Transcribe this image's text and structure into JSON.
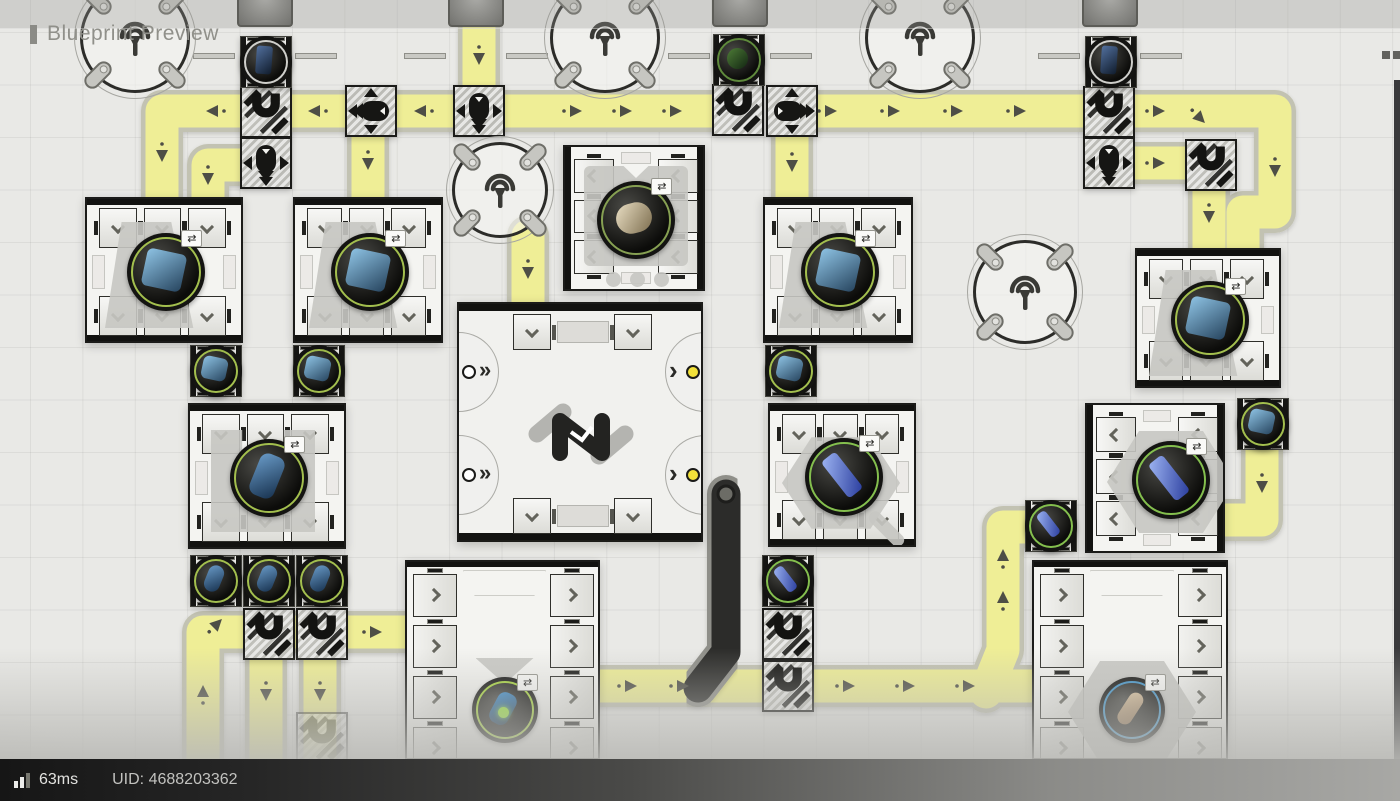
{
  "header": {
    "title": "Blueprint Preview"
  },
  "statusbar": {
    "ping": "63ms",
    "uid": "UID: 4688203362",
    "signal_icon": "signal-bars-icon",
    "signal_bars": [
      7,
      11,
      15
    ],
    "signal_colors": [
      "#ececea",
      "#ececea",
      "#77776f"
    ]
  },
  "colors": {
    "belt": "#efee96",
    "belt_edge": "#c2c2b2",
    "dark_belt": "#2c2c2a",
    "dark_belt_edge": "#8f8f89",
    "arrow": "#4e4e46",
    "tile_frame": "#1b1b19",
    "machine_bg": "#f4f4f1",
    "hatch_bg": "#cfcfca",
    "silhouette": "#c6c6c2",
    "port_dot_yellow": "#f2e13a",
    "port_dot_white": "#ffffff"
  },
  "items": {
    "blue-ore": {
      "label": "blue-ore-icon",
      "ring": "#a3bf4e",
      "grad": [
        "#8ec3e4",
        "#27455f"
      ],
      "w": 40,
      "h": 38,
      "rot": 12,
      "rad": 6
    },
    "blue-bottle": {
      "label": "blue-bottle-icon",
      "ring": "#a3bf4e",
      "grad": [
        "#6a9cc9",
        "#16304d"
      ],
      "w": 26,
      "h": 44,
      "rot": 22,
      "rad": 9
    },
    "blue-crystal": {
      "label": "blue-crystal-icon",
      "ring": "#84bf4e",
      "grad": [
        "#9db4f2",
        "#2b3e9e"
      ],
      "w": 18,
      "h": 46,
      "rot": -38,
      "rad": 4
    },
    "mushroom": {
      "label": "mushroom-icon",
      "ring": "#86a052",
      "grad": [
        "#eadfc4",
        "#7c6d4e"
      ],
      "w": 36,
      "h": 30,
      "rot": -15,
      "rad": 15
    },
    "plant": {
      "label": "plant-icon",
      "ring": "#5f8a3c",
      "grad": [
        "#4e7c37",
        "#122612"
      ],
      "w": 34,
      "h": 34,
      "rot": 0,
      "rad": 17
    },
    "battery": {
      "label": "battery-icon",
      "ring": "#a6d43c",
      "grad": [
        "#3f93d6",
        "#0e2438"
      ],
      "w": 24,
      "h": 40,
      "rot": 28,
      "rad": 8,
      "accent": "#97e23c"
    },
    "capsule": {
      "label": "capsule-icon",
      "ring": "#3f93c9",
      "grad": [
        "#dec7a4",
        "#8a6a48"
      ],
      "w": 18,
      "h": 42,
      "rot": 33,
      "rad": 9
    },
    "blue-building": {
      "label": "blue-building-icon",
      "ring": "#cfcfcb",
      "grad": [
        "#52709e",
        "#101c2c"
      ],
      "w": 26,
      "h": 46,
      "rot": 4,
      "rad": 3
    }
  },
  "factory": {
    "belts": [
      [
        [
          248,
          111
        ],
        [
          162,
          111
        ],
        [
          162,
          197
        ]
      ],
      [
        [
          240,
          165
        ],
        [
          208,
          165
        ],
        [
          208,
          197
        ]
      ],
      [
        [
          292,
          111
        ],
        [
          349,
          111
        ]
      ],
      [
        [
          398,
          111
        ],
        [
          455,
          111
        ]
      ],
      [
        [
          503,
          111
        ],
        [
          714,
          111
        ]
      ],
      [
        [
          816,
          111
        ],
        [
          1085,
          111
        ]
      ],
      [
        [
          368,
          131
        ],
        [
          368,
          197
        ]
      ],
      [
        [
          479,
          28
        ],
        [
          479,
          89
        ]
      ],
      [
        [
          792,
          133
        ],
        [
          792,
          197
        ]
      ],
      [
        [
          1132,
          111
        ],
        [
          1275,
          111
        ],
        [
          1275,
          212
        ],
        [
          1243,
          212
        ],
        [
          1243,
          250
        ]
      ],
      [
        [
          1132,
          163
        ],
        [
          1209,
          163
        ],
        [
          1209,
          250
        ]
      ],
      [
        [
          1262,
          446
        ],
        [
          1262,
          520
        ],
        [
          1226,
          520
        ]
      ],
      [
        [
          528,
          236
        ],
        [
          528,
          304
        ]
      ],
      [
        [
          600,
          686
        ],
        [
          1034,
          686
        ]
      ],
      [
        [
          986,
          692
        ],
        [
          1003,
          650
        ],
        [
          1003,
          527
        ],
        [
          1027,
          527
        ]
      ],
      [
        [
          203,
          775
        ],
        [
          203,
          632
        ],
        [
          407,
          632
        ]
      ],
      [
        [
          266,
          652
        ],
        [
          266,
          758
        ]
      ],
      [
        [
          320,
          652
        ],
        [
          320,
          758
        ]
      ]
    ],
    "dark_pipe": [
      [
        726,
        494
      ],
      [
        726,
        652
      ],
      [
        698,
        688
      ]
    ],
    "arrows": [
      [
        213,
        111,
        "l"
      ],
      [
        162,
        155,
        "d"
      ],
      [
        208,
        178,
        "d"
      ],
      [
        315,
        111,
        "l"
      ],
      [
        421,
        111,
        "l"
      ],
      [
        575,
        111,
        "r"
      ],
      [
        625,
        111,
        "r"
      ],
      [
        675,
        111,
        "r"
      ],
      [
        830,
        111,
        "r"
      ],
      [
        893,
        111,
        "r"
      ],
      [
        956,
        111,
        "r"
      ],
      [
        1019,
        111,
        "r"
      ],
      [
        368,
        163,
        "d"
      ],
      [
        479,
        58,
        "d"
      ],
      [
        792,
        165,
        "d"
      ],
      [
        1158,
        111,
        "r"
      ],
      [
        1200,
        118,
        "dr"
      ],
      [
        1275,
        170,
        "d"
      ],
      [
        1158,
        163,
        "r"
      ],
      [
        1209,
        216,
        "d"
      ],
      [
        1262,
        486,
        "d"
      ],
      [
        528,
        272,
        "d"
      ],
      [
        630,
        686,
        "r"
      ],
      [
        682,
        686,
        "r"
      ],
      [
        848,
        686,
        "r"
      ],
      [
        908,
        686,
        "r"
      ],
      [
        968,
        686,
        "r"
      ],
      [
        1003,
        598,
        "u"
      ],
      [
        1003,
        556,
        "u"
      ],
      [
        217,
        624,
        "ur"
      ],
      [
        203,
        692,
        "u"
      ],
      [
        375,
        632,
        "r"
      ],
      [
        266,
        694,
        "d"
      ],
      [
        320,
        694,
        "d"
      ]
    ],
    "machines": [
      {
        "id": "refiner-1",
        "type": "v",
        "x": 85,
        "y": 197,
        "w": 158,
        "h": 146,
        "item": "blue-ore",
        "sil": "trapezoid"
      },
      {
        "id": "refiner-2",
        "type": "v",
        "x": 293,
        "y": 197,
        "w": 150,
        "h": 146,
        "item": "blue-ore",
        "sil": "trapezoid"
      },
      {
        "id": "refiner-3",
        "type": "v",
        "x": 763,
        "y": 197,
        "w": 150,
        "h": 146,
        "item": "blue-ore",
        "sil": "trapezoid"
      },
      {
        "id": "refiner-4",
        "type": "v",
        "x": 1135,
        "y": 248,
        "w": 146,
        "h": 140,
        "item": "blue-ore",
        "sil": "trapezoid"
      },
      {
        "id": "filler-1",
        "type": "v",
        "x": 188,
        "y": 403,
        "w": 158,
        "h": 146,
        "item": "blue-bottle",
        "sil": "bracket"
      },
      {
        "id": "crystallizer-1",
        "type": "v",
        "x": 768,
        "y": 403,
        "w": 148,
        "h": 144,
        "item": "blue-crystal",
        "sil": "hex"
      },
      {
        "id": "press-1",
        "type": "h",
        "x": 563,
        "y": 145,
        "w": 142,
        "h": 146,
        "item": "mushroom",
        "sil": "press"
      },
      {
        "id": "crystallizer-2",
        "type": "h",
        "x": 1085,
        "y": 403,
        "w": 140,
        "h": 150,
        "item": "blue-crystal",
        "sil": "hexbig",
        "itemdx": 14
      },
      {
        "id": "assembler-1",
        "type": "tall",
        "x": 405,
        "y": 560,
        "w": 195,
        "h": 200,
        "item": "battery",
        "sil": "funnel"
      },
      {
        "id": "assembler-2",
        "type": "tall",
        "x": 1032,
        "y": 560,
        "w": 196,
        "h": 200,
        "item": "capsule",
        "sil": "hexbig"
      }
    ],
    "containers": [
      {
        "x": 240,
        "y": 36,
        "item": "blue-building"
      },
      {
        "x": 713,
        "y": 34,
        "item": "plant"
      },
      {
        "x": 1085,
        "y": 36,
        "item": "blue-building"
      },
      {
        "x": 190,
        "y": 345,
        "item": "blue-ore"
      },
      {
        "x": 293,
        "y": 345,
        "item": "blue-ore"
      },
      {
        "x": 765,
        "y": 345,
        "item": "blue-ore"
      },
      {
        "x": 1237,
        "y": 398,
        "item": "blue-ore"
      },
      {
        "x": 762,
        "y": 555,
        "item": "blue-crystal"
      },
      {
        "x": 1025,
        "y": 500,
        "item": "blue-crystal"
      },
      {
        "x": 190,
        "y": 555,
        "item": "blue-bottle"
      },
      {
        "x": 243,
        "y": 555,
        "item": "blue-bottle"
      },
      {
        "x": 296,
        "y": 555,
        "item": "blue-bottle"
      }
    ],
    "splitters": [
      {
        "x": 345,
        "y": 85,
        "pill": "left",
        "arrows": [
          "up",
          "left",
          "down"
        ]
      },
      {
        "x": 453,
        "y": 85,
        "pill": "down",
        "arrows": [
          "left",
          "right",
          "down"
        ]
      },
      {
        "x": 240,
        "y": 137,
        "pill": "down",
        "arrows": [
          "left",
          "right",
          "down"
        ]
      },
      {
        "x": 766,
        "y": 85,
        "pill": "right",
        "arrows": [
          "up",
          "right",
          "down"
        ]
      },
      {
        "x": 1083,
        "y": 137,
        "pill": "down",
        "arrows": [
          "left",
          "right",
          "down"
        ]
      }
    ],
    "bridges": [
      {
        "x": 240,
        "y": 86
      },
      {
        "x": 712,
        "y": 84
      },
      {
        "x": 1083,
        "y": 86
      },
      {
        "x": 1185,
        "y": 139
      },
      {
        "x": 243,
        "y": 608
      },
      {
        "x": 296,
        "y": 608
      },
      {
        "x": 762,
        "y": 608
      },
      {
        "x": 762,
        "y": 660
      },
      {
        "x": 296,
        "y": 712,
        "faded": true
      }
    ],
    "antennas": [
      {
        "cx": 135,
        "cy": 38,
        "r": 55
      },
      {
        "cx": 605,
        "cy": 38,
        "r": 55
      },
      {
        "cx": 920,
        "cy": 38,
        "r": 55
      },
      {
        "cx": 500,
        "cy": 190,
        "r": 48
      },
      {
        "cx": 1025,
        "cy": 292,
        "r": 52
      }
    ],
    "domes": [
      {
        "cx": 265
      },
      {
        "cx": 476
      },
      {
        "cx": 740
      },
      {
        "cx": 1110
      }
    ],
    "hub": {
      "x": 457,
      "y": 302,
      "w": 246,
      "h": 240
    },
    "wall": {
      "x": 1394,
      "y": 80,
      "w": 6,
      "h": 721,
      "squares": [
        [
          1382,
          51
        ],
        [
          1393,
          51
        ]
      ]
    }
  }
}
